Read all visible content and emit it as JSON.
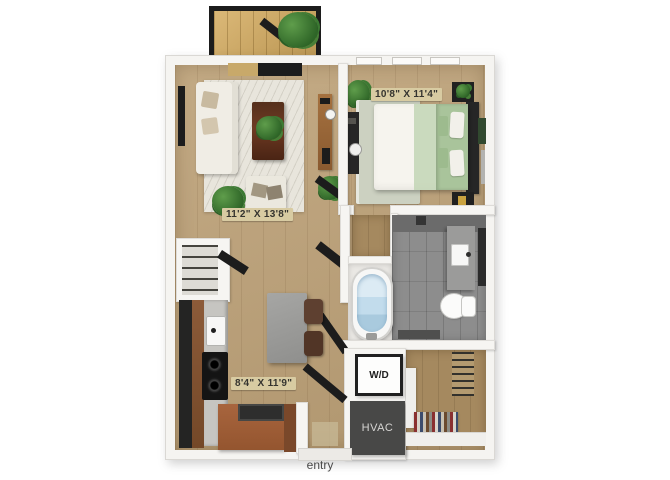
{
  "labels": {
    "living_dims": "11'2\" X 13'8\"",
    "bedroom_dims": "10'8\" X 11'4\"",
    "kitchen_dims": "8'4\" X 11'9\"",
    "washer_dryer": "W/D",
    "hvac": "HVAC",
    "entry": "entry"
  },
  "colors": {
    "wall": "#f5f4f1",
    "wood_floor": "#bda177",
    "bathroom_tile": "#8d8d8d",
    "balcony_wood": "#d5ac60",
    "label_chip": "#d8cba2",
    "hvac_box": "#484847",
    "bedding_green": "#a9c49b"
  }
}
